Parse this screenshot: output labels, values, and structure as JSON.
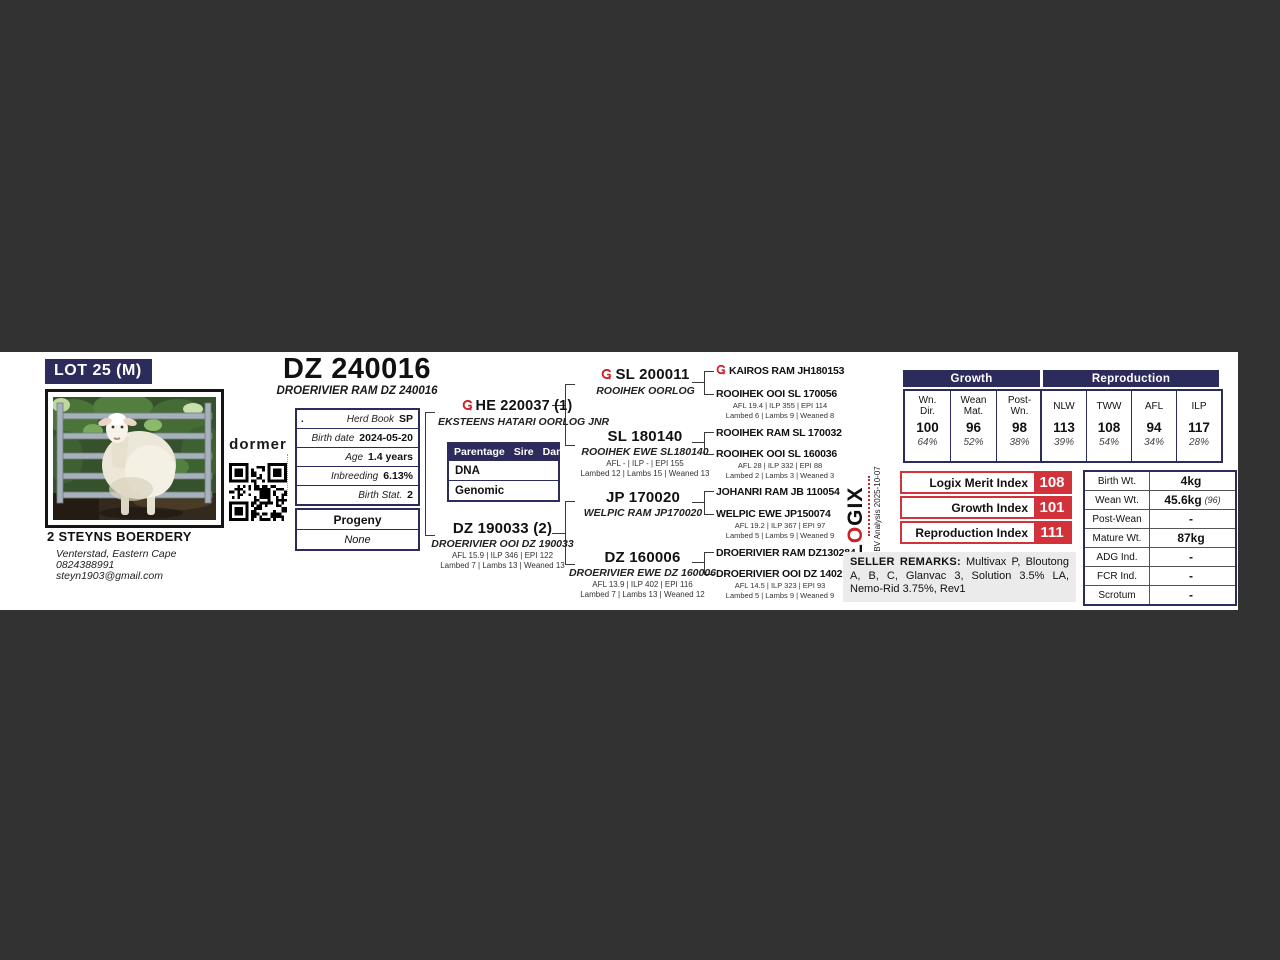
{
  "colors": {
    "navy": "#2b2c5b",
    "red": "#d23239",
    "page_background": "#323232",
    "band_background": "#ffffff"
  },
  "lot": {
    "label": "LOT 25 (M)"
  },
  "title": {
    "id": "DZ 240016",
    "full_name": "DROERIVIER RAM DZ 240016"
  },
  "brand": {
    "breed_logo": "dormer"
  },
  "breeder": {
    "name": "2 STEYNS BOERDERY",
    "location": "Venterstad, Eastern Cape",
    "phone": "0824388991",
    "email": "steyn1903@gmail.com"
  },
  "details": {
    "rows": [
      {
        "prefix": ".",
        "label": "Herd Book",
        "value": "SP"
      },
      {
        "label": "Birth date",
        "value": "2024-05-20"
      },
      {
        "label": "Age",
        "value": "1.4 years"
      },
      {
        "label": "Inbreeding",
        "value": "6.13%"
      },
      {
        "label": "Birth Stat.",
        "value": "2"
      }
    ]
  },
  "progeny": {
    "title": "Progeny",
    "value": "None"
  },
  "parentage": {
    "header": [
      "Parentage",
      "Sire",
      "Dam"
    ],
    "rows": [
      "DNA",
      "Genomic"
    ]
  },
  "pedigree": {
    "sire": {
      "id": "HE 220037 (1)",
      "name": "EKSTEENS HATARI OORLOG JNR"
    },
    "dam": {
      "id": "DZ 190033 (2)",
      "name": "DROERIVIER OOI DZ 190033",
      "stats": "AFL 15.9 | ILP 346 | EPI 122",
      "lambing": "Lambed 7 | Lambs 13 | Weaned 13"
    },
    "sire_sire": {
      "id": "SL 200011",
      "name": "ROOIHEK OORLOG"
    },
    "sire_dam": {
      "id": "SL 180140",
      "name": "ROOIHEK EWE SL180140",
      "stats": "AFL - | ILP - | EPI 155",
      "lambing": "Lambed 12 | Lambs 15 | Weaned 13"
    },
    "dam_sire": {
      "id": "JP 170020",
      "name": "WELPIC RAM JP170020"
    },
    "dam_dam": {
      "id": "DZ 160006",
      "name": "DROERIVIER EWE DZ 160006",
      "stats": "AFL 13.9 | ILP 402 | EPI 116",
      "lambing": "Lambed 7 | Lambs 13 | Weaned 12"
    },
    "gen3": [
      {
        "name": "KAIROS RAM JH180153"
      },
      {
        "name": "ROOIHEK OOI SL 170056",
        "stats": "AFL 19.4 | ILP 355 | EPI 114",
        "lambing": "Lambed 6 | Lambs 9 | Weaned 8"
      },
      {
        "name": "ROOIHEK RAM SL 170032"
      },
      {
        "name": "ROOIHEK OOI SL 160036",
        "stats": "AFL 28 | ILP 332 | EPI 88",
        "lambing": "Lambed 2 | Lambs 3 | Weaned 3"
      },
      {
        "name": "JOHANRI RAM JB 110054"
      },
      {
        "name": "WELPIC EWE JP150074",
        "stats": "AFL 19.2 | ILP 367 | EPI 97",
        "lambing": "Lambed 5 | Lambs 9 | Weaned 9"
      },
      {
        "name": "DROERIVIER RAM DZ130284"
      },
      {
        "name": "DROERIVIER OOI DZ 140210",
        "stats": "AFL 14.5 | ILP 323 | EPI 93",
        "lambing": "Lambed 5 | Lambs 9 | Weaned 9"
      }
    ]
  },
  "ebv": {
    "growth": {
      "title": "Growth",
      "columns": [
        {
          "h1": "Wn.",
          "h2": "Dir.",
          "value": "100",
          "acc": "64%"
        },
        {
          "h1": "Wean",
          "h2": "Mat.",
          "value": "96",
          "acc": "52%"
        },
        {
          "h1": "Post-",
          "h2": "Wn.",
          "value": "98",
          "acc": "38%"
        }
      ]
    },
    "reproduction": {
      "title": "Reproduction",
      "columns": [
        {
          "h1": "NLW",
          "h2": "",
          "value": "113",
          "acc": "39%"
        },
        {
          "h1": "TWW",
          "h2": "",
          "value": "108",
          "acc": "54%"
        },
        {
          "h1": "AFL",
          "h2": "",
          "value": "94",
          "acc": "34%"
        },
        {
          "h1": "ILP",
          "h2": "",
          "value": "117",
          "acc": "28%"
        }
      ]
    }
  },
  "indices": [
    {
      "label": "Logix Merit Index",
      "value": "108"
    },
    {
      "label": "Growth Index",
      "value": "101"
    },
    {
      "label": "Reproduction Index",
      "value": "111"
    }
  ],
  "logix": {
    "l": "L",
    "o": "O",
    "gix": "GIX",
    "analysis": "EBV Analysis 2025-10-07"
  },
  "weights": {
    "rows": [
      {
        "label": "Birth Wt.",
        "value": "4kg",
        "note": ""
      },
      {
        "label": "Wean Wt.",
        "value": "45.6kg",
        "note": "(96)"
      },
      {
        "label": "Post-Wean",
        "value": "-",
        "note": ""
      },
      {
        "label": "Mature Wt.",
        "value": "87kg",
        "note": ""
      },
      {
        "label": "ADG Ind.",
        "value": "-",
        "note": ""
      },
      {
        "label": "FCR Ind.",
        "value": "-",
        "note": ""
      },
      {
        "label": "Scrotum",
        "value": "-",
        "note": ""
      }
    ]
  },
  "seller_remarks": {
    "title": "SELLER REMARKS:",
    "text": "Multivax P, Bloutong A, B, C, Glanvac 3, Solution 3.5% LA, Nemo-Rid 3.75%, Rev1"
  }
}
